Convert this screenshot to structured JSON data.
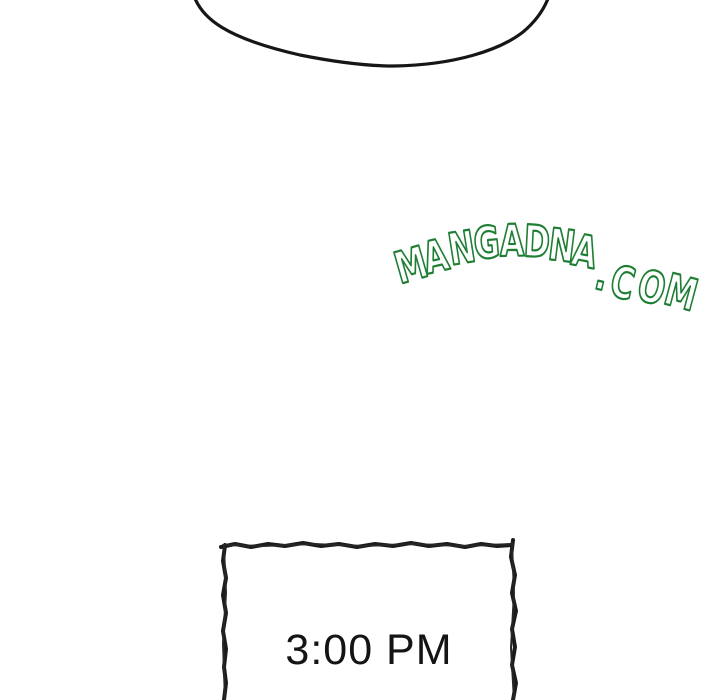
{
  "scene": {
    "background_color": "#ffffff",
    "ink_color": "#1a1a1a"
  },
  "speech_bubble": {
    "description": "bottom arc of large empty speech bubble, cut off by top edge"
  },
  "watermark": {
    "text": "MANGADNA.COM",
    "color": "#1e7e34"
  },
  "time_panel": {
    "label": "3:00 PM"
  }
}
